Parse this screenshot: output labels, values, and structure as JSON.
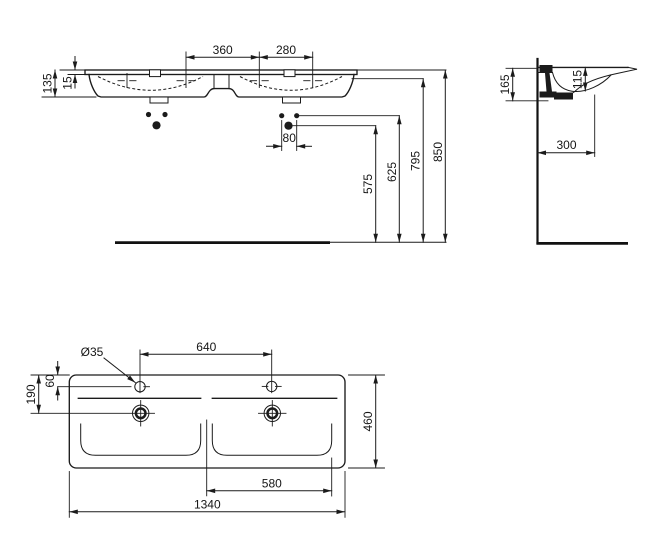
{
  "drawing": {
    "title": "Double washbasin technical drawing",
    "front_view": {
      "dim_center_tap_spacing": "360",
      "dim_right_tap_spacing": "280",
      "dim_basin_height": "135",
      "dim_rim_thickness": "15",
      "dim_fixing_hole_spacing": "80",
      "dim_drain_height": "575",
      "dim_fixing_height": "625",
      "dim_underside_height": "795",
      "dim_rim_height": "850"
    },
    "side_view": {
      "dim_front_edge_height": "165",
      "dim_bowl_depth": "115",
      "dim_wall_offset": "300"
    },
    "plan_view": {
      "label_tap_hole_diameter": "Ø35",
      "dim_tap_hole_spacing": "640",
      "dim_tap_hole_offset": "60",
      "dim_drain_offset": "190",
      "dim_overall_depth": "460",
      "dim_bowl_width": "580",
      "dim_overall_width": "1340"
    }
  }
}
